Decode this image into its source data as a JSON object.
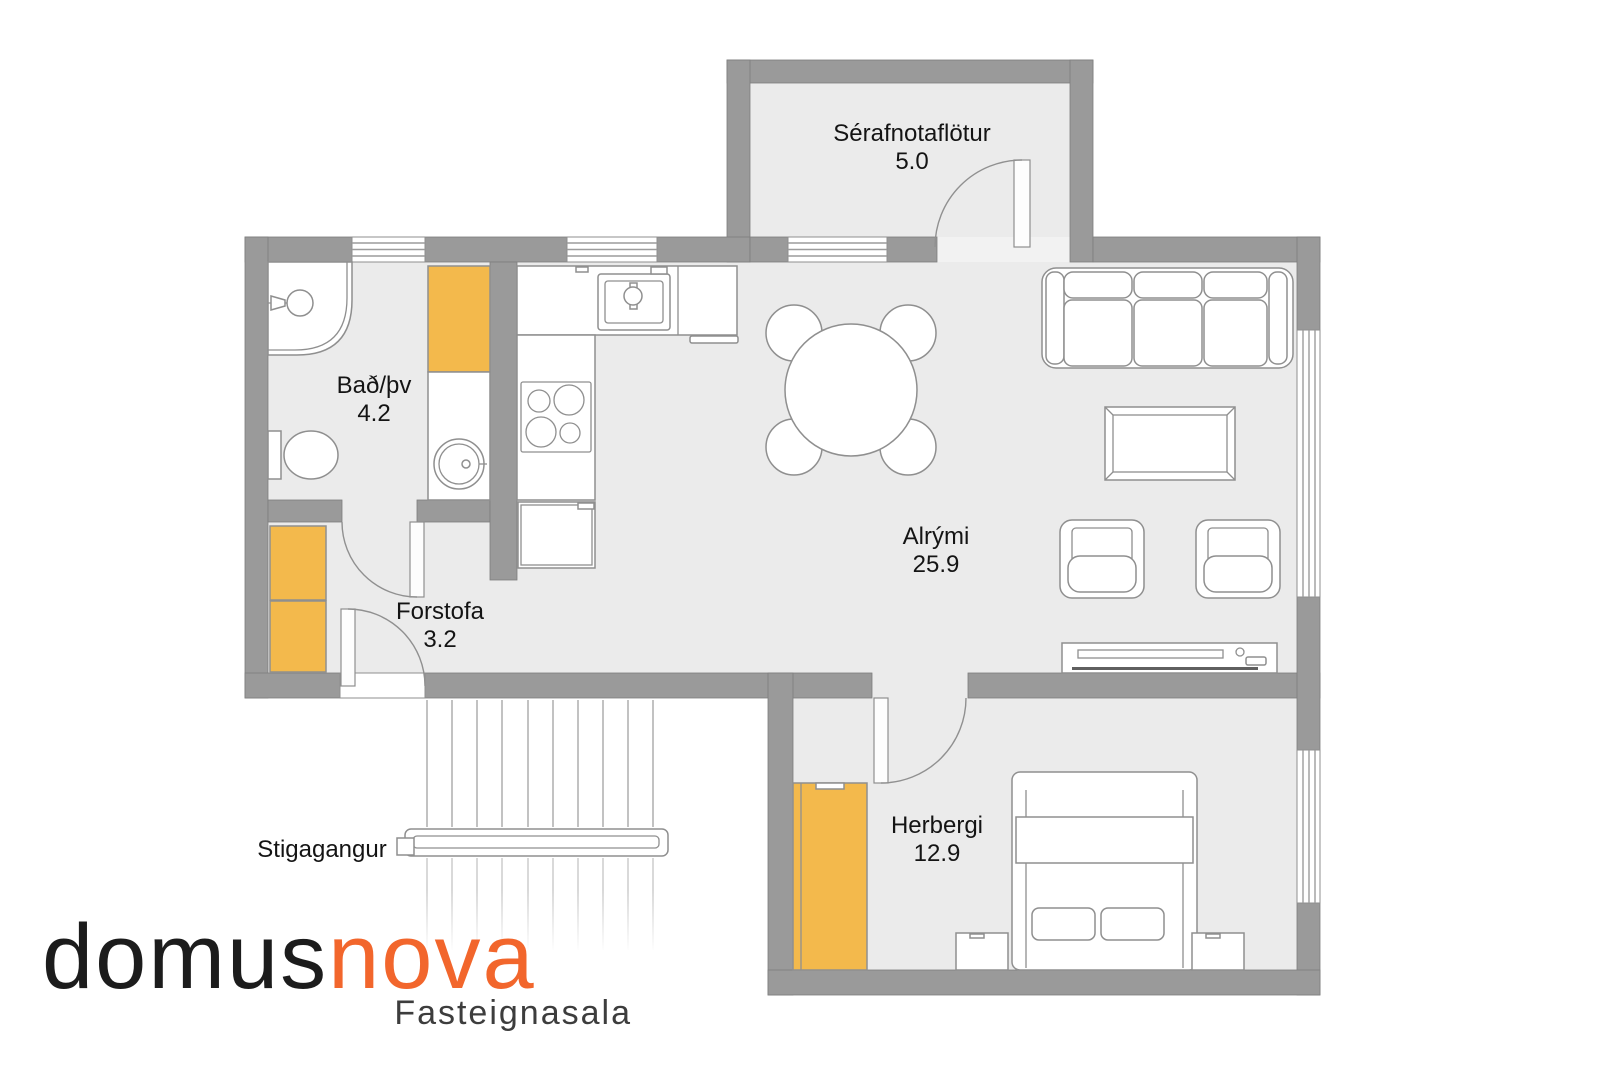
{
  "plan": {
    "colors": {
      "wall": "#9a9a9a",
      "floor": "#ebebeb",
      "cabinet": "#f3b94c"
    },
    "rooms": [
      {
        "id": "serafnotaflotur",
        "label": "Sérafnotaflötur",
        "area": "5.0"
      },
      {
        "id": "bad-thv",
        "label": "Bað/þv",
        "area": "4.2"
      },
      {
        "id": "forstofa",
        "label": "Forstofa",
        "area": "3.2"
      },
      {
        "id": "alrymi",
        "label": "Alrými",
        "area": "25.9"
      },
      {
        "id": "herbergi",
        "label": "Herbergi",
        "area": "12.9"
      },
      {
        "id": "stigagangur",
        "label": "Stigagangur",
        "area": ""
      }
    ]
  },
  "logo": {
    "part1": "domus",
    "part2": "nova",
    "subtitle": "Fasteignasala",
    "part1_color": "#1c1c1c",
    "part2_color": "#f2662c",
    "subtitle_color": "#3d3d3d"
  }
}
